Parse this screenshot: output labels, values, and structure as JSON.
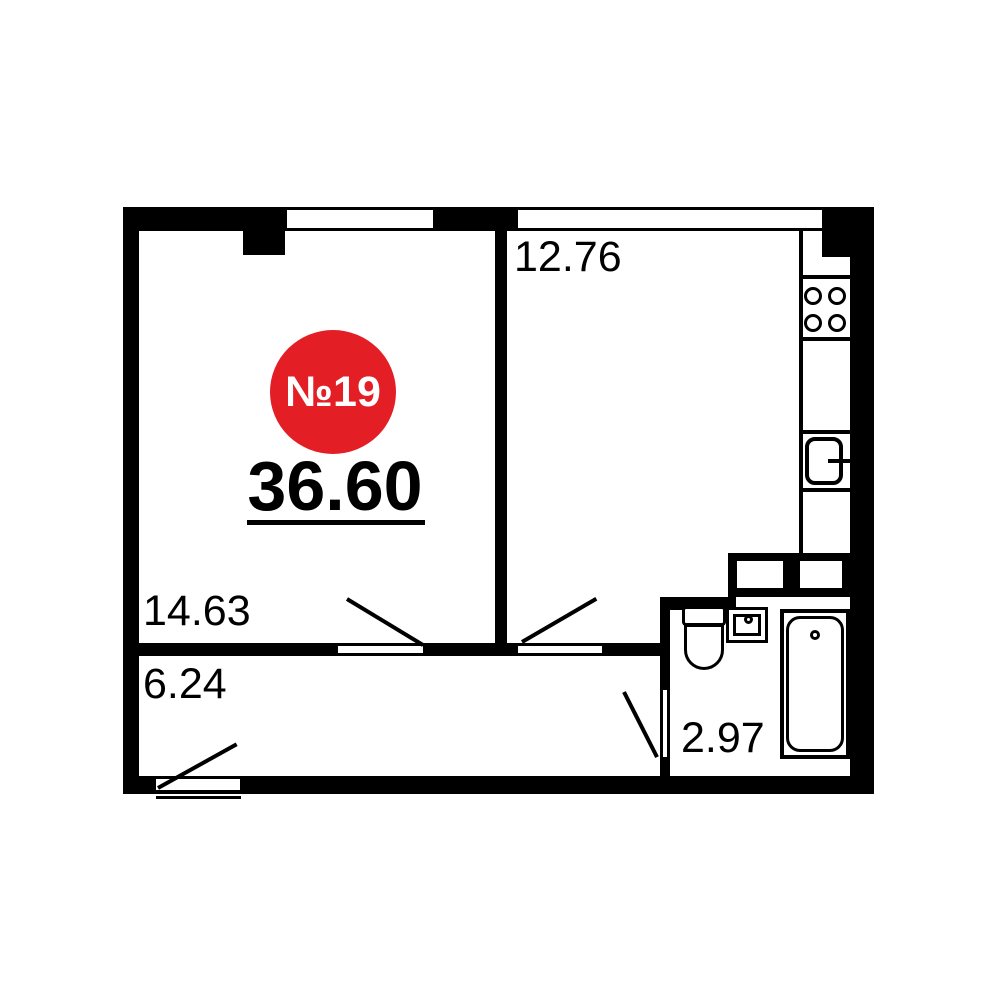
{
  "floor_plan": {
    "badge": {
      "unit_number": "№19",
      "color": "#e31e25",
      "text_color": "#ffffff"
    },
    "total_area": "36.60",
    "rooms": [
      {
        "name": "living-room",
        "area": "14.63"
      },
      {
        "name": "kitchen-living-room",
        "area": "12.76"
      },
      {
        "name": "hallway",
        "area": "6.24"
      },
      {
        "name": "bathroom",
        "area": "2.97"
      }
    ],
    "fixtures": [
      "stove-4-burners",
      "kitchen-sink",
      "toilet",
      "washbasin",
      "bathtub",
      "vent-shaft-left",
      "vent-shaft-right"
    ],
    "colors": {
      "walls": "#000000",
      "background": "#ffffff",
      "badge": "#e31e25"
    }
  }
}
